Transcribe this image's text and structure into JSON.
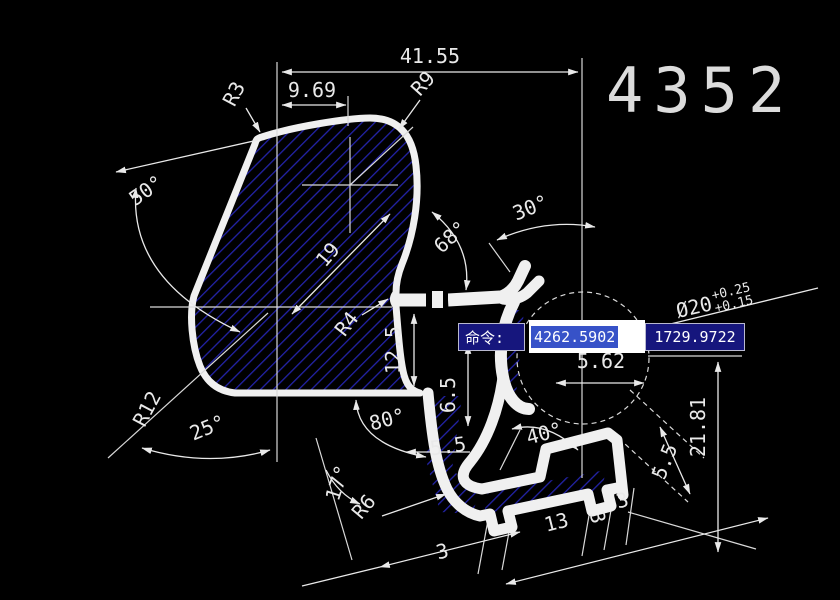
{
  "drawing_number": "4352",
  "command_bar": {
    "prompt": "命令:",
    "x_value": "4262.5902",
    "y_value": "1729.9722"
  },
  "dims": {
    "w4155": "41.55",
    "w969": "9.69",
    "r3": "R3",
    "r9": "R9",
    "a50": "50°",
    "a68": "68°",
    "a30": "30°",
    "l19": "19",
    "r4": "R4",
    "h125": "12.5",
    "h65": "6.5",
    "w562": "5.62",
    "dia": "Ø20",
    "tol_upper": "+0.25",
    "tol_lower": "+0.15",
    "r12": "R12",
    "a25": "25°",
    "a80": "80°",
    "w55": "5.5",
    "a17": "17°",
    "r6": "R6",
    "a40": "40°",
    "b3_left": "3",
    "b13": "13",
    "b3_mid": "3",
    "b3_right": "3",
    "h2181": "21.81",
    "w55_right": "5.5"
  },
  "colors": {
    "background": "#000000",
    "line": "#f0f0f0",
    "hatch_blue": "#2323a8",
    "panel_blue": "#16167d",
    "selection_blue": "#3752c8"
  }
}
